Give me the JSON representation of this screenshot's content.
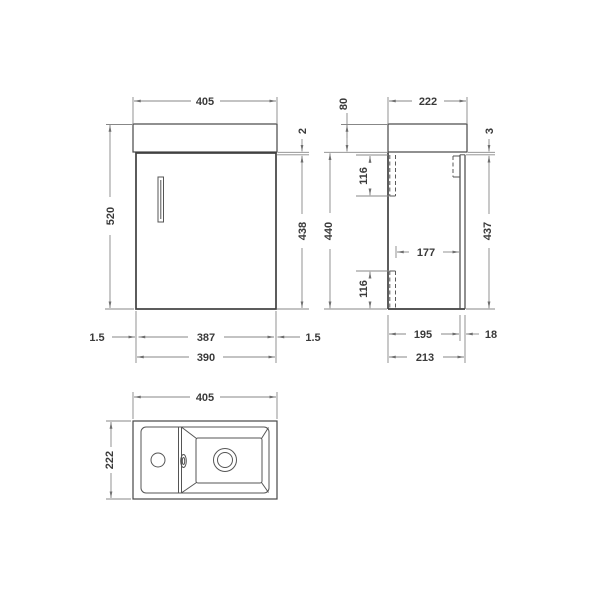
{
  "front_view": {
    "overall_width": "405",
    "overall_height": "520",
    "worktop_overhang": "2",
    "door_height": "438",
    "door_gap_left": "1.5",
    "door_width": "387",
    "door_gap_right": "1.5",
    "cabinet_width": "390"
  },
  "side_view": {
    "basin_height": "80",
    "overall_depth": "222",
    "top_gap": "3",
    "bracket_top_offset": "116",
    "cabinet_height": "440",
    "internal_depth": "177",
    "bracket_bottom_offset": "116",
    "door_height": "437",
    "cabinet_depth": "195",
    "door_thickness": "18",
    "total_depth": "213"
  },
  "plan_view": {
    "overall_width": "405",
    "overall_depth": "222"
  }
}
